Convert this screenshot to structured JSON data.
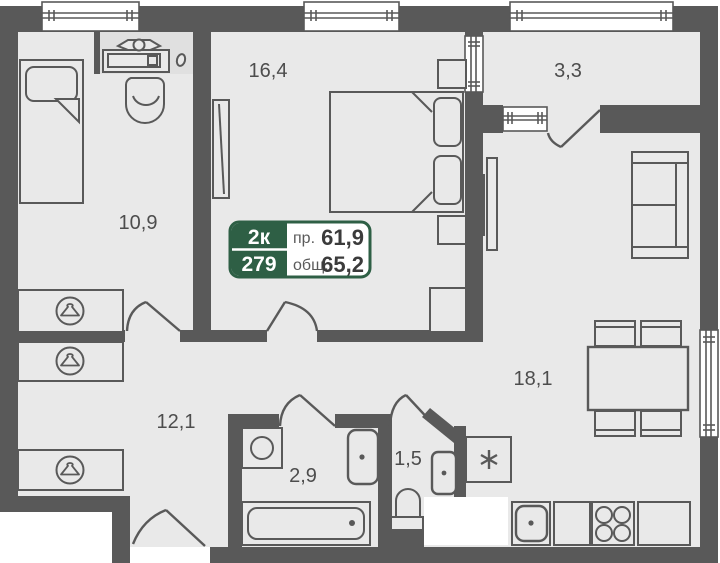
{
  "plan": {
    "unit_card": {
      "rooms_label": "2к",
      "unit_number": "279",
      "living_label": "пр.",
      "living_area": "61,9",
      "total_label": "общ.",
      "total_area": "65,2"
    },
    "rooms": {
      "bedroom1": {
        "area": "10,9"
      },
      "bedroom2": {
        "area": "16,4"
      },
      "balcony": {
        "area": "3,3"
      },
      "hallway": {
        "area": "12,1"
      },
      "bathroom": {
        "area": "2,9"
      },
      "wc": {
        "area": "1,5"
      },
      "living": {
        "area": "18,1"
      }
    },
    "icons": {
      "wardrobe": "hanger-in-circle",
      "fridge": "snowflake-asterisk"
    },
    "colors": {
      "wall": "#595959",
      "floor": "#e9e9e9",
      "accent_green": "#2e5f45",
      "label_text": "#4d4d4d",
      "white": "#ffffff"
    }
  }
}
